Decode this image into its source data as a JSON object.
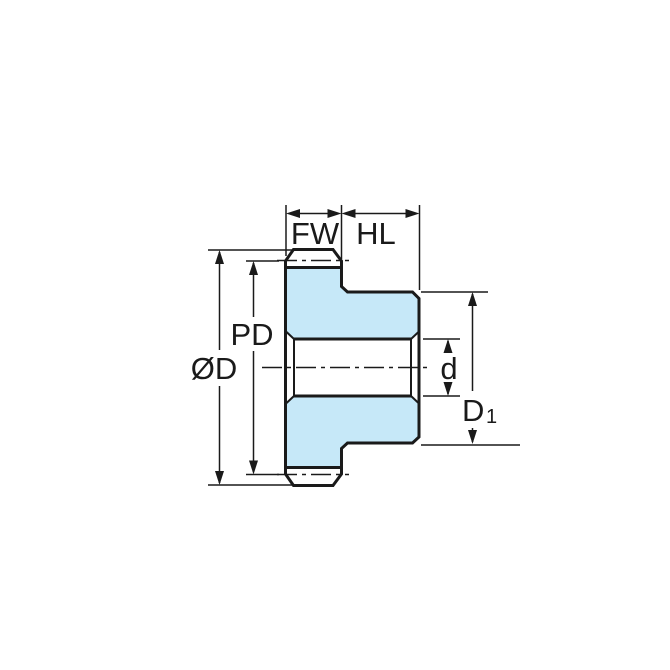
{
  "diagram": {
    "type": "technical-drawing",
    "subject": "spur gear with hub, side cross-section with dimension callouts",
    "labels": {
      "face_width": "FW",
      "hub_length": "HL",
      "pitch_diameter": "PD",
      "outside_diameter": "ØD",
      "bore_diameter": "d",
      "hub_diameter_base": "D",
      "hub_diameter_sub": "1"
    },
    "colors": {
      "gear_fill": "#c6e8f8",
      "line": "#1a1a1a",
      "background": "#ffffff"
    }
  }
}
